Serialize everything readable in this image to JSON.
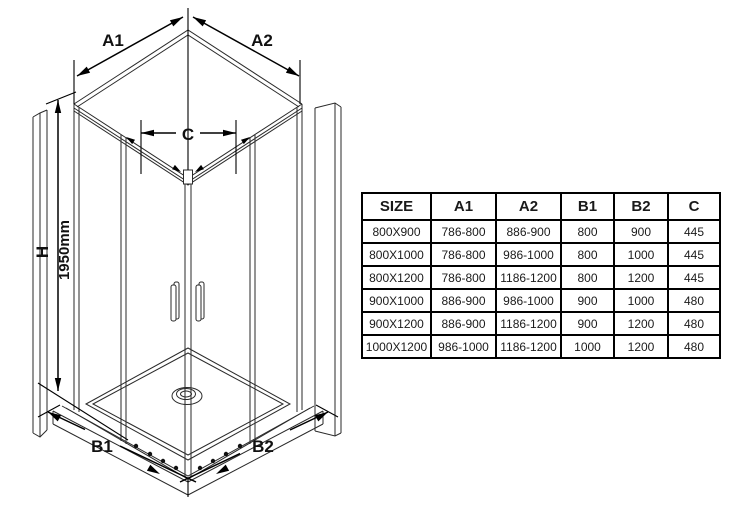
{
  "colors": {
    "background": "#ffffff",
    "structure_line": "#2a2a2a",
    "dimension_line": "#000000",
    "table_border": "#000000"
  },
  "diagram": {
    "title": "corner-entry shower enclosure dimension drawing",
    "dimension_labels": {
      "a1": "A1",
      "a2": "A2",
      "b1": "B1",
      "b2": "B2",
      "c": "C",
      "h": "H",
      "height": "1950mm"
    }
  },
  "table": {
    "headers": [
      "SIZE",
      "A1",
      "A2",
      "B1",
      "B2",
      "C"
    ],
    "rows": [
      [
        "800X900",
        "786-800",
        "886-900",
        "800",
        "900",
        "445"
      ],
      [
        "800X1000",
        "786-800",
        "986-1000",
        "800",
        "1000",
        "445"
      ],
      [
        "800X1200",
        "786-800",
        "1186-1200",
        "800",
        "1200",
        "445"
      ],
      [
        "900X1000",
        "886-900",
        "986-1000",
        "900",
        "1000",
        "480"
      ],
      [
        "900X1200",
        "886-900",
        "1186-1200",
        "900",
        "1200",
        "480"
      ],
      [
        "1000X1200",
        "986-1000",
        "1186-1200",
        "1000",
        "1200",
        "480"
      ]
    ]
  }
}
